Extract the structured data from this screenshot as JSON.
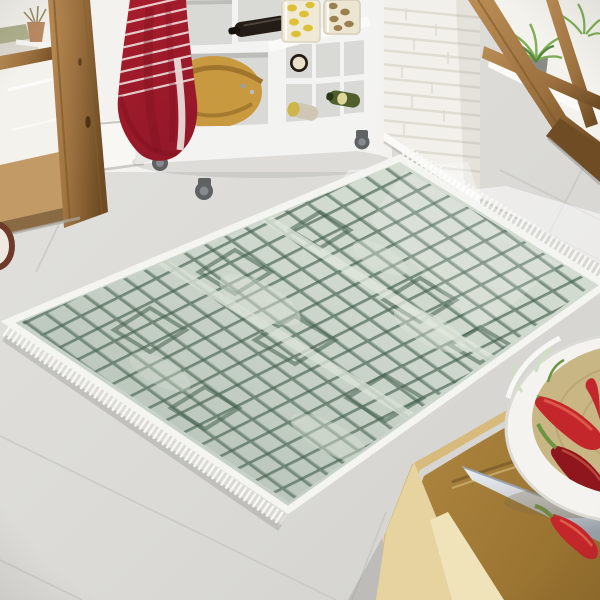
{
  "scene": {
    "label": "Kitchen scene with a sage green diamond-lattice fringed area rug on light tile floor",
    "objects": [
      "left-wood-door-window",
      "outdoor-flower-pot",
      "red-striped-towel",
      "white-kitchen-cart",
      "wooden-salad-bowl",
      "wine-bottles",
      "pasta-jars",
      "cart-casters",
      "white-brick-column",
      "right-glass-door",
      "potted-ferns",
      "tile-floor",
      "area-rug",
      "rug-fringe",
      "wooden-table",
      "cutting-board",
      "kitchen-knife",
      "chili-bowl",
      "red-chili-peppers"
    ]
  },
  "colors": {
    "floor": "#dbdad6",
    "floor_grout": "#c6c5c1",
    "wall_white": "#f3f2ef",
    "baseboard": "#f8f7f4",
    "door_wood": "#9c713f",
    "door_wood_dark": "#6f4c24",
    "door_wood_light": "#bb8d55",
    "glass": "#f4f2ed",
    "outdoor_green": "#a3a67b",
    "outdoor_ground": "#dedad1",
    "pot_terracotta": "#b98a63",
    "towel_red": "#a81d2b",
    "towel_red_dark": "#7e1220",
    "towel_stripe": "#e9d9d8",
    "cart_white": "#f3f3f1",
    "cart_side": "#e7e7e4",
    "cart_opening": "#d9d9d6",
    "cart_opening_shadow": "#bdbdba",
    "bowl_wood": "#c9993f",
    "bowl_wood_dark": "#9f742c",
    "bottle_dark": "#241d17",
    "bottle_green": "#4f5e2c",
    "bottle_label": "#e8e0c8",
    "bottle_cap_yellow": "#cdb64a",
    "bottle_body_pale": "#cfc6b4",
    "jar_glass": "#efe9d6",
    "pasta_yellow": "#dcc138",
    "pasta_brown": "#9b7f4e",
    "caster_gray": "#5f6163",
    "caster_light": "#878a8e",
    "brick_white": "#f2f0ea",
    "brick_mortar": "#dcd8cf",
    "plant_green": "#7fae56",
    "plant_green_dark": "#55853d",
    "plant_pot_gray": "#8a8a86",
    "rug_base": "#ccd6cc",
    "rug_base_light": "#dfe6db",
    "rug_line": "#44604f",
    "rug_border": "#f4f5f0",
    "rug_fringe": "#f7f7f3",
    "sun_white": "#ffffff",
    "table_wood": "#b28a43",
    "table_wood_dark": "#97712f",
    "table_edge": "#d7ba7c",
    "table_front": "#e6d3a0",
    "table_front_light": "#f0e3ba",
    "board_groove": "#7e5f2a",
    "knife_blade": "#ccd1d6",
    "knife_blade_dark": "#99a0a7",
    "chili_red": "#c3272b",
    "chili_red_dark": "#8f161d",
    "chili_highlight": "#f08060",
    "chili_stem": "#6d9440",
    "stem_pale": "#cfe0c2",
    "bowl_white": "#f4f3ef",
    "bowl_inner": "#c8b685",
    "bowl_inner_line": "#b29f6c",
    "shadow": "#8f8f8b"
  }
}
